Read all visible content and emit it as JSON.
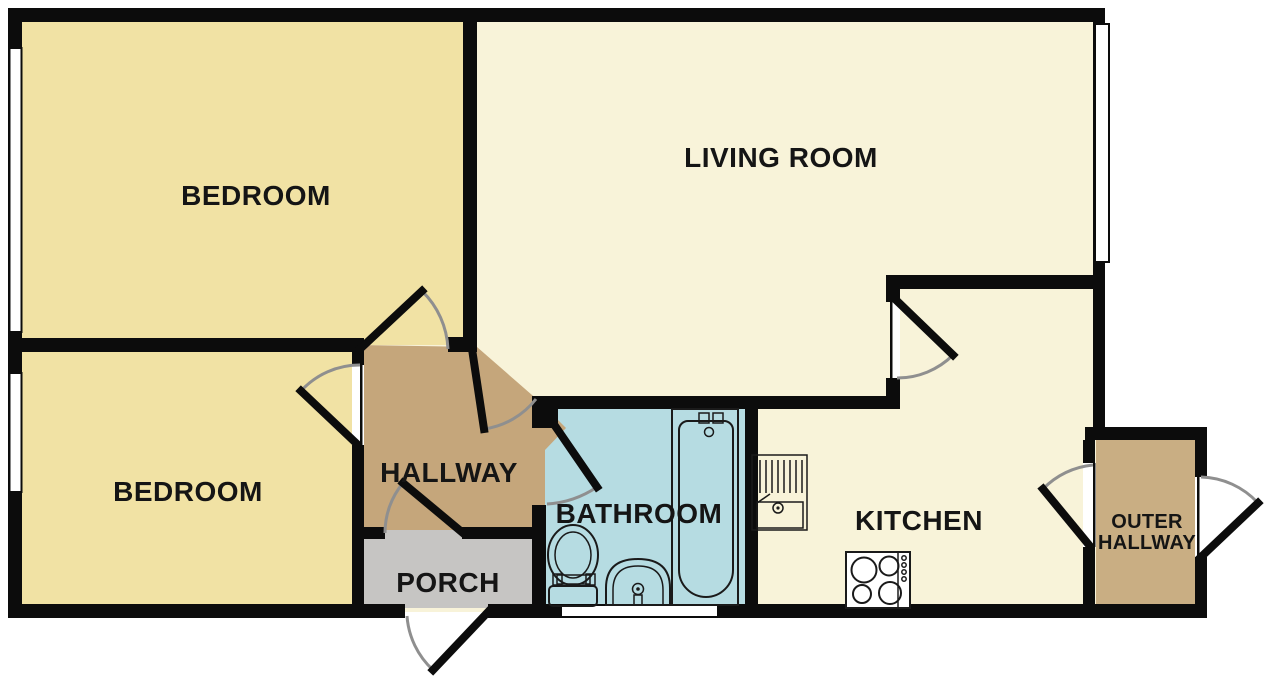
{
  "rooms": {
    "bedroom_top": {
      "label": "BEDROOM"
    },
    "living_room": {
      "label": "LIVING ROOM"
    },
    "bedroom_bottom": {
      "label": "BEDROOM"
    },
    "hallway": {
      "label": "HALLWAY"
    },
    "porch": {
      "label": "PORCH"
    },
    "bathroom": {
      "label": "BATHROOM"
    },
    "kitchen": {
      "label": "KITCHEN"
    },
    "outer_hallway": {
      "label_line1": "OUTER",
      "label_line2": "HALLWAY"
    }
  },
  "colors": {
    "background": "#ffffff",
    "wall": "#0c0c0c",
    "bedroom_fill": "#f1e2a4",
    "living_fill": "#f8f3d9",
    "hallway_fill": "#c5a67b",
    "outer_hallway_fill": "#c9ae83",
    "porch_fill": "#c6c5c3",
    "bathroom_fill": "#b6dce2",
    "door_arc": "#8f8f8f",
    "label_text": "#151515"
  },
  "fixtures": {
    "bathtub": "bathtub-icon",
    "toilet": "toilet-icon",
    "basin": "sink-basin-icon",
    "kitchen_sink": "kitchen-sink-drainer-icon",
    "stove": "stove-hob-icon"
  }
}
